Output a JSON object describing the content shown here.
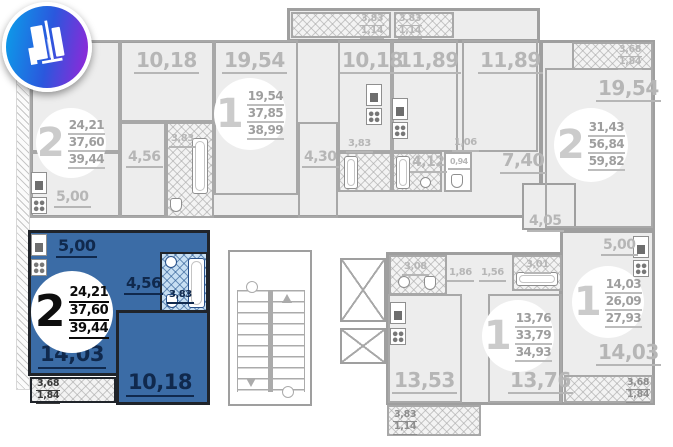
{
  "colors": {
    "highlight": "#3b6ca6",
    "wall_gray": "#9f9f9f",
    "room_fill": "#ededed",
    "label_gray": "#b6b6b6",
    "logo_gradient_start": "#0aa0ea",
    "logo_gradient_end": "#9a23d8"
  },
  "apartments": [
    {
      "number": "2",
      "living_area": "24,21",
      "floor_area": "37,60",
      "total_area": "39,44",
      "selected": false
    },
    {
      "number": "1",
      "living_area": "19,54",
      "floor_area": "37,85",
      "total_area": "38,99",
      "selected": false
    },
    {
      "number": "2",
      "living_area": "31,43",
      "floor_area": "56,84",
      "total_area": "59,82",
      "selected": false
    },
    {
      "number": "2",
      "living_area": "24,21",
      "floor_area": "37,60",
      "total_area": "39,44",
      "selected": true
    },
    {
      "number": "1",
      "living_area": "13,76",
      "floor_area": "33,79",
      "total_area": "34,93",
      "selected": false
    },
    {
      "number": "1",
      "living_area": "14,03",
      "floor_area": "26,09",
      "total_area": "27,93",
      "selected": false
    }
  ],
  "rooms": {
    "tl_room_1018": "10,18",
    "tl_kitchen": "5,00",
    "tl_hall": "4,56",
    "tl_bath": "3,83",
    "tc_room_1954": "19,54",
    "tc_room_1018": "10,18",
    "tc_hall": "4,30",
    "center_bath_a": "3,83",
    "center_bath_b": "4,12",
    "center_wc": "0,94",
    "center_lobby": "1,06",
    "kitchen_room_a": "11,89",
    "kitchen_room_b": "11,89",
    "tr_room_1954": "19,54",
    "tr_corridor": "7,40",
    "tr_hall": "4,05",
    "bc_bath_a": "3,08",
    "bc_hall_a": "1,86",
    "bc_hall_b": "1,56",
    "bc_bath_b": "3,01",
    "bc_room_1353": "13,53",
    "bc_room_1376": "13,76",
    "br_kitchen": "5,00",
    "br_room_1403": "14,03",
    "bl_kitchen": "5,00",
    "bl_hall": "4,56",
    "bl_bath": "3,83",
    "bl_room_1403": "14,03",
    "bl_room_1018": "10,18"
  },
  "balconies": {
    "top_a": {
      "area": "3,83",
      "reduced": "1,14"
    },
    "top_b": {
      "area": "3,83",
      "reduced": "1,14"
    },
    "top_right": {
      "area": "3,68",
      "reduced": "1,84"
    },
    "bottom_left": {
      "area": "3,68",
      "reduced": "1,84"
    },
    "bottom_center": {
      "area": "3,83",
      "reduced": "1,14"
    },
    "bottom_right": {
      "area": "3,68",
      "reduced": "1,84"
    }
  },
  "icons": {
    "logo": "developer-building-logo",
    "stove": "stove-icon",
    "hob": "hob-icon",
    "bathtub": "bathtub-icon",
    "sink": "sink-icon",
    "toilet": "toilet-icon",
    "elevator": "elevator-shaft-icon",
    "stairs": "staircase-icon"
  }
}
